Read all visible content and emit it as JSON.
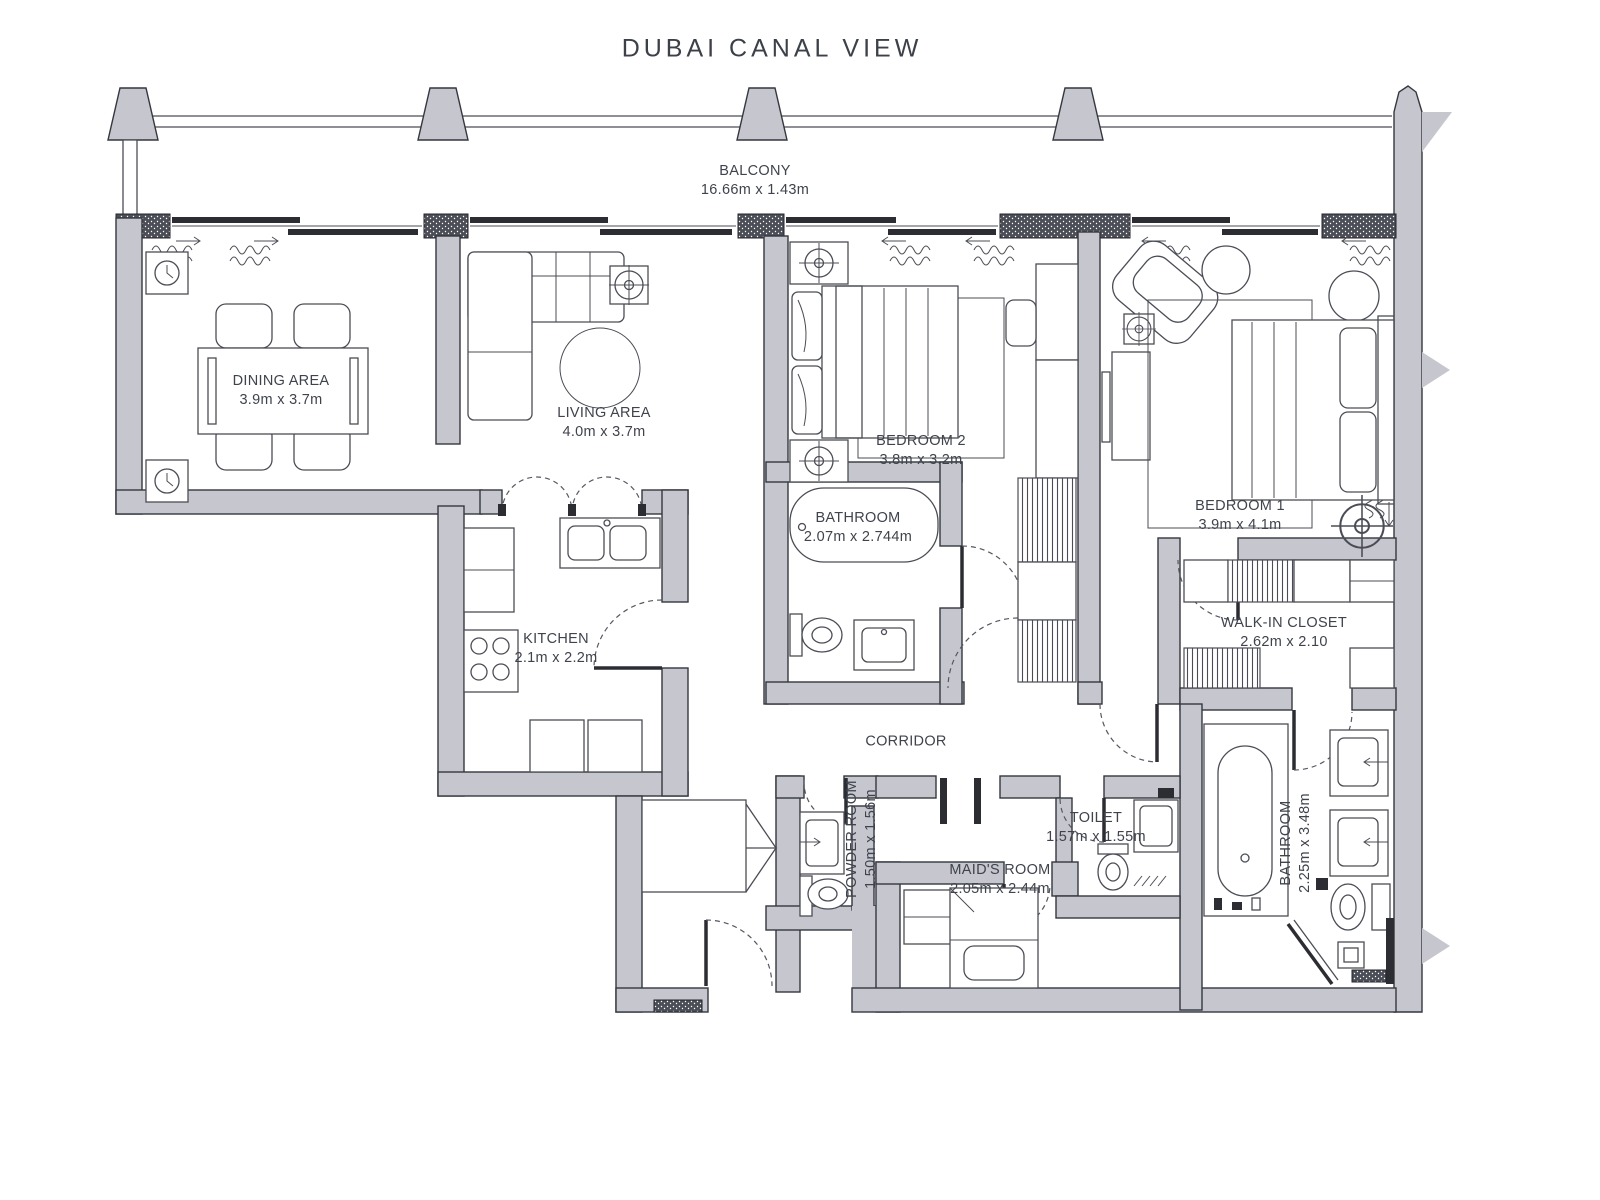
{
  "title": "DUBAI CANAL VIEW",
  "rooms": {
    "balcony": {
      "name": "BALCONY",
      "dims": "16.66m x 1.43m"
    },
    "dining": {
      "name": "DINING AREA",
      "dims": "3.9m x 3.7m"
    },
    "living": {
      "name": "LIVING AREA",
      "dims": "4.0m x 3.7m"
    },
    "bedroom2": {
      "name": "BEDROOM 2",
      "dims": "3.8m x 3.2m"
    },
    "bedroom1": {
      "name": "BEDROOM 1",
      "dims": "3.9m x 4.1m"
    },
    "bathroom2": {
      "name": "BATHROOM",
      "dims": "2.07m x 2.744m"
    },
    "kitchen": {
      "name": "KITCHEN",
      "dims": "2.1m x 2.2m"
    },
    "walk_in_closet": {
      "name": "WALK-IN CLOSET",
      "dims": "2.62m x 2.10"
    },
    "corridor": {
      "name": "CORRIDOR",
      "dims": ""
    },
    "powder_room": {
      "name": "POWDER ROOM",
      "dims": "1.50m x 1.56m"
    },
    "toilet": {
      "name": "TOILET",
      "dims": "1.57m x 1.55m"
    },
    "maids_room": {
      "name": "MAID'S ROOM",
      "dims": "2.05m x 2.44m"
    },
    "bathroom1": {
      "name": "BATHROOM",
      "dims": "2.25m x 3.48m"
    }
  },
  "colors": {
    "wall_fill": "#c6c6ce",
    "outline": "#34373f",
    "text": "#3f434c",
    "background": "#ffffff"
  }
}
